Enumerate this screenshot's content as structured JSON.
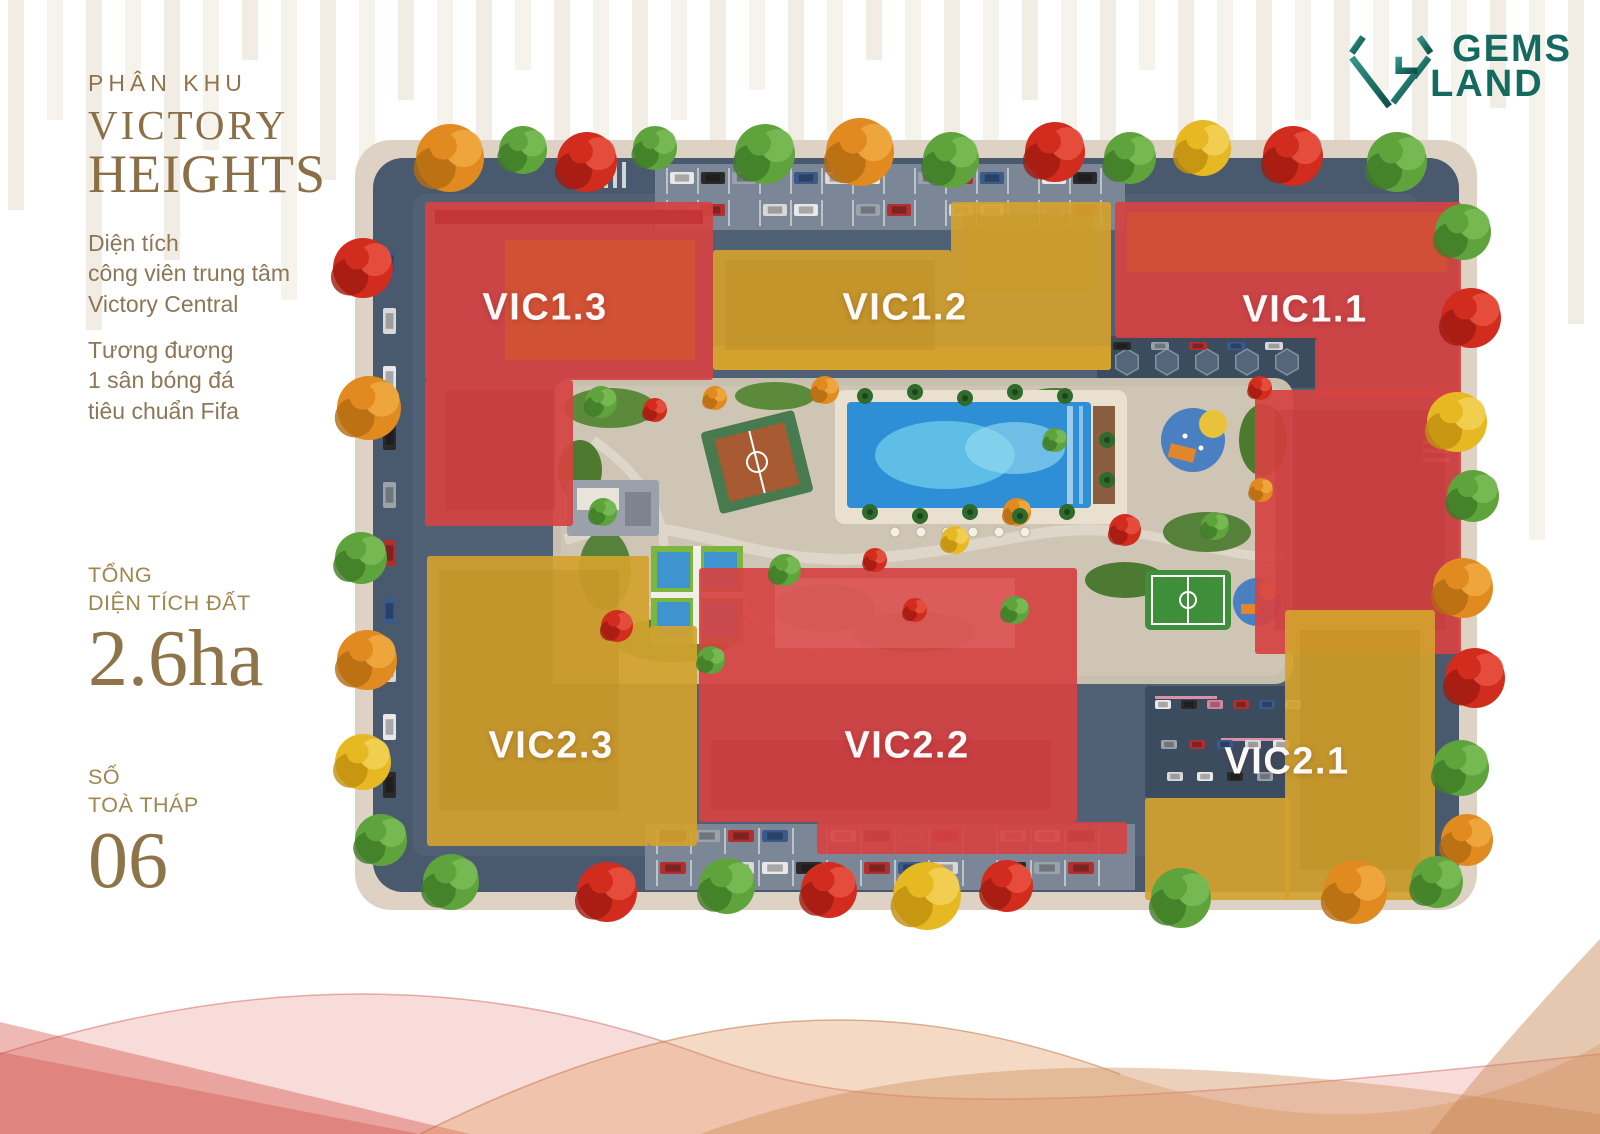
{
  "page": {
    "background": "#ffffff"
  },
  "sidebar": {
    "section_label": "PHÂN KHU",
    "title_line1": "VICTORY",
    "title_line2": "HEIGHTS",
    "description1": {
      "line1": "Diện tích",
      "line2": "công viên trung tâm",
      "line3": "Victory Central"
    },
    "description2": {
      "line1": "Tương đương",
      "line2": "1 sân bóng đá",
      "line3": "tiêu chuẩn Fifa"
    },
    "stat_area": {
      "label_line1": "TỔNG",
      "label_line2": "DIỆN TÍCH ĐẤT",
      "value": "2.6ha"
    },
    "stat_towers": {
      "label_line1": "SỐ",
      "label_line2": "TOÀ THÁP",
      "value": "06"
    },
    "text_color": "#8f744a"
  },
  "logo": {
    "brand_line1": "GEMS",
    "brand_line2": "LAND",
    "color": "#17695f"
  },
  "map": {
    "title": "Victory Heights master plan (aerial site view)",
    "towers": [
      {
        "id": "VIC1.3",
        "zone_color": "#d64242",
        "position": "top-left"
      },
      {
        "id": "VIC1.2",
        "zone_color": "#d4a22e",
        "position": "top-center"
      },
      {
        "id": "VIC1.1",
        "zone_color": "#d64242",
        "position": "top-right"
      },
      {
        "id": "VIC2.3",
        "zone_color": "#d4a22e",
        "position": "bottom-left"
      },
      {
        "id": "VIC2.2",
        "zone_color": "#d64242",
        "position": "bottom-center"
      },
      {
        "id": "VIC2.1",
        "zone_color": "#d4a22e",
        "position": "bottom-right"
      }
    ],
    "amenities": [
      "central park",
      "swimming pool",
      "basketball court",
      "tennis courts",
      "mini football pitch",
      "playgrounds",
      "parking areas",
      "perimeter roads with trees"
    ]
  }
}
